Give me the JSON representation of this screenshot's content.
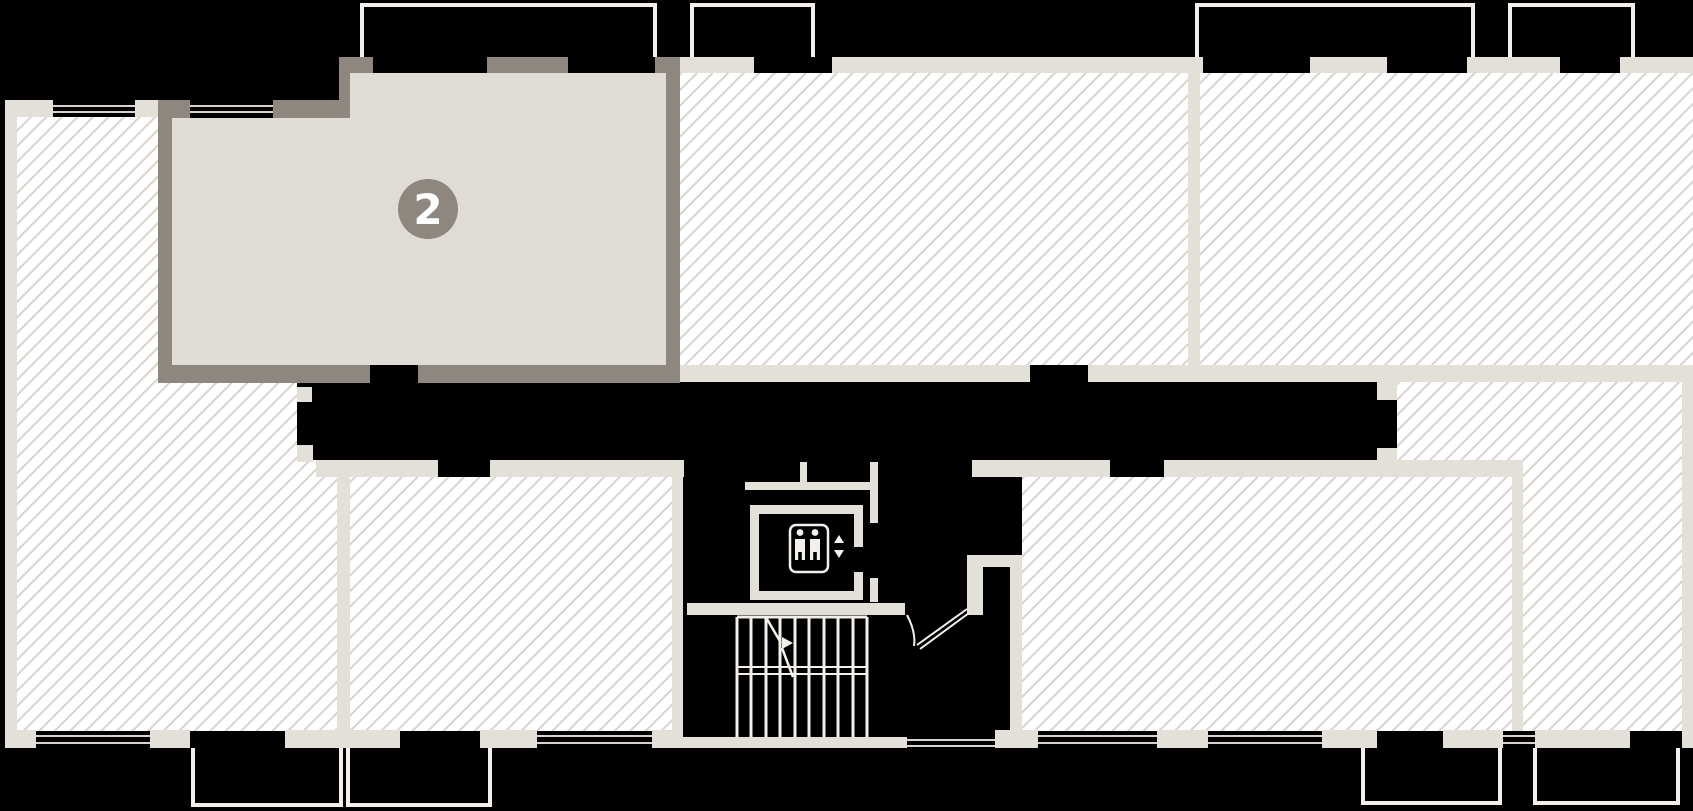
{
  "unit_badge": {
    "label": "2"
  },
  "colors": {
    "background": "#000000",
    "room-fill": "#ffffff",
    "hatch-line": "#d8d3ce",
    "wall": "#e3dfd9",
    "selected-wall": "#8e8780",
    "selected-fill": "#dfdbd5",
    "badge-fill": "#8e8780",
    "badge-text": "#ffffff",
    "outline": "#f3f0ec"
  },
  "icons": {
    "elevator": "elevator-passengers-icon",
    "elevator_up": "triangle-up",
    "elevator_down": "triangle-down",
    "stairs": "stairs-direction-arrow-icon"
  }
}
